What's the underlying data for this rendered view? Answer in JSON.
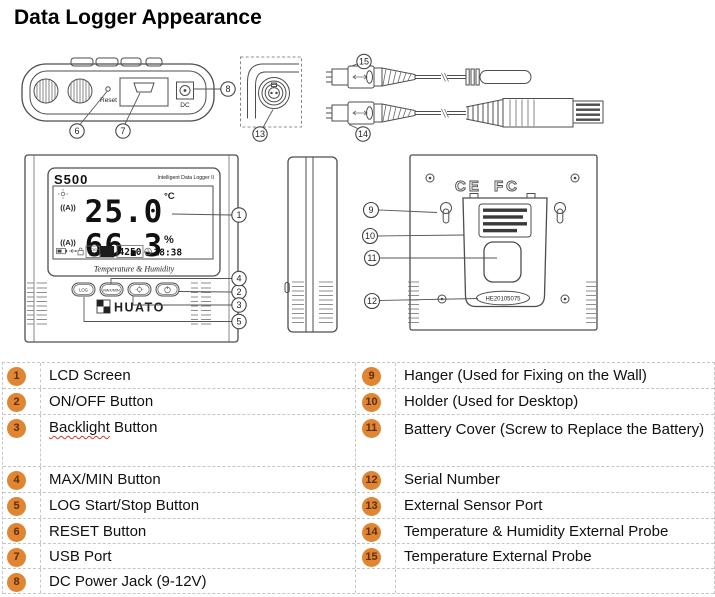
{
  "title": "Data Logger Appearance",
  "colors": {
    "badge_fill": "#E08532",
    "badge_text": "#5D2F06",
    "table_border": "#C6C6C6",
    "drawing_line": "#4D4D4D",
    "squiggle_red": "#C43C35"
  },
  "diagram": {
    "callouts": [
      "1",
      "2",
      "3",
      "4",
      "5",
      "6",
      "7",
      "8",
      "9",
      "10",
      "11",
      "12",
      "13",
      "14",
      "15"
    ],
    "top_view": {
      "reset_label": "Reset",
      "dc_label": "DC"
    },
    "front_view": {
      "logo": "S500",
      "subtitle": "Intelligent Data Logger II",
      "antenna_glyph": "((A))",
      "temperature": "25.0",
      "temperature_unit": "°C",
      "humidity": "66.3",
      "humidity_unit": "%",
      "log_label": "LOG",
      "log_cn": "记录",
      "mem_label": "MEM",
      "mem_cn": "内存",
      "memory_count": "4250",
      "time": "18:38",
      "screen_caption": "Temperature & Humidity",
      "button_log": "LOG",
      "button_maxmin": "MAX/MIN",
      "brand": "HUATO"
    },
    "back_view": {
      "ce_mark": "CE",
      "fcc_mark": "FC",
      "serial_number": "HE20105075"
    }
  },
  "legend": {
    "left": [
      {
        "num": "1",
        "label": "LCD Screen"
      },
      {
        "num": "2",
        "label": "ON/OFF Button"
      },
      {
        "num": "3",
        "label": "Backlight Button",
        "misspelled_word": "Backlight",
        "label_rest": " Button"
      },
      {
        "num": "4",
        "label": "MAX/MIN Button"
      },
      {
        "num": "5",
        "label": "LOG Start/Stop Button"
      },
      {
        "num": "6",
        "label": "RESET Button"
      },
      {
        "num": "7",
        "label": "USB Port"
      },
      {
        "num": "8",
        "label": "DC Power Jack (9-12V)"
      }
    ],
    "right": [
      {
        "num": "9",
        "label": "Hanger (Used for Fixing on the Wall)"
      },
      {
        "num": "10",
        "label": "Holder (Used for Desktop)"
      },
      {
        "num": "11",
        "label": "Battery Cover (Screw to Replace the Battery)"
      },
      {
        "num": "12",
        "label": "Serial Number"
      },
      {
        "num": "13",
        "label": "External Sensor Port"
      },
      {
        "num": "14",
        "label": "Temperature & Humidity External Probe"
      },
      {
        "num": "15",
        "label": "Temperature External Probe"
      }
    ]
  }
}
